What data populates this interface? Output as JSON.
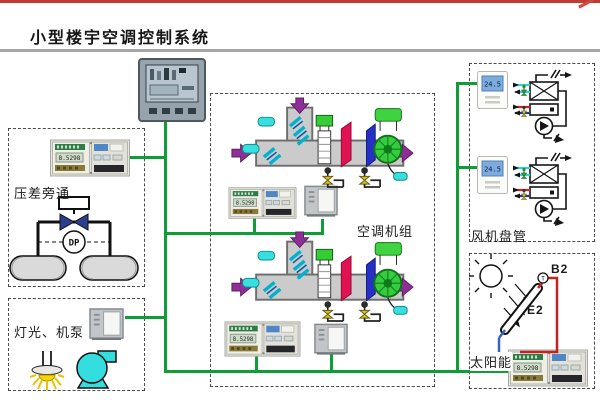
{
  "page": {
    "title": "小型楼宇空调控制系统"
  },
  "panels": {
    "bypass": {
      "label": "压差旁通",
      "dp": "DP"
    },
    "lighting": {
      "label": "灯光、机泵"
    },
    "ahu": {
      "label": "空调机组"
    },
    "fcu": {
      "label": "风机盘管",
      "thermostat_value": "24.5"
    },
    "solar": {
      "label": "太阳能",
      "sensor_b2": "B2",
      "collector_e2": "E2",
      "temp_tag": "T"
    }
  },
  "devices": {
    "controller_lcd": "8.5298"
  },
  "colors": {
    "bus_green": "#0f9d38",
    "top_red": "#c23b33",
    "cyan": "#35dede",
    "coil_red": "#e21153",
    "coil_blue": "#2531c4",
    "arrow_purple": "#8d2f96"
  },
  "icons": {
    "hmi-touch-panel": "rounded gray screen with buttons",
    "din-controller": "beige rail module with lcd",
    "io-panel": "gray cabinet with white door",
    "thermostat": "white unit with blue lcd",
    "sun-icon": "circle with rays",
    "lamp-icon": "bulb with yellow glow",
    "pump-icon": "cyan volute pump",
    "valve-icon": "bowtie valve with actuator",
    "dp-sensor-icon": "circle marked DP",
    "fan-icon": "green impeller circle",
    "heat-exchanger-icon": "box with X",
    "solar-collector-icon": "tilted tube with T sensor"
  }
}
